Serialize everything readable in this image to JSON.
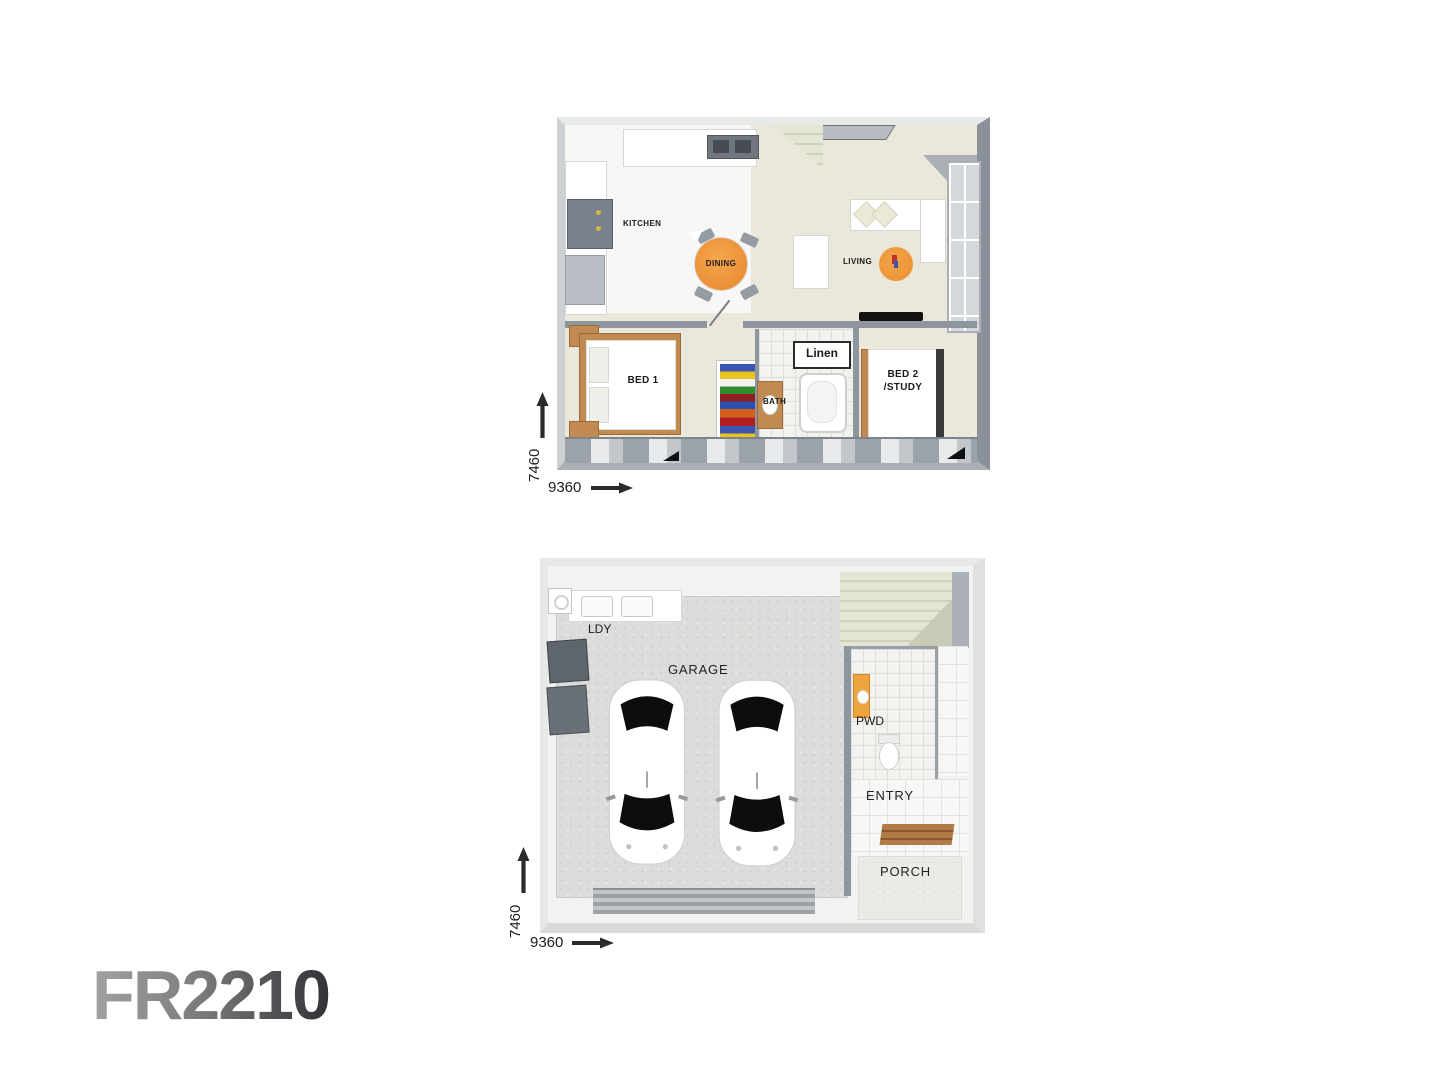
{
  "sheet": {
    "background": "#ffffff"
  },
  "logo": {
    "text": "FR2210",
    "gradient_start": "#a2a2a2",
    "gradient_end": "#323237"
  },
  "upper_floor": {
    "labels": {
      "kitchen": "KITCHEN",
      "dining": "DINING",
      "living": "LIVING",
      "bed1": "BED 1",
      "bath": "BATH",
      "linen": "Linen",
      "bed2_line1": "BED 2",
      "bed2_line2": "/STUDY"
    },
    "dimensions": {
      "depth": "7460",
      "width": "9360"
    }
  },
  "lower_floor": {
    "labels": {
      "laundry": "LDY",
      "garage": "GARAGE",
      "powder": "PWD",
      "entry": "ENTRY",
      "porch": "PORCH"
    },
    "dimensions": {
      "depth": "7460",
      "width": "9360"
    }
  },
  "icons": {
    "up_arrow": "↑",
    "right_arrow": "→",
    "car_top_view": "car",
    "toilet": "toilet",
    "sink": "sink",
    "dining_table": "round-table",
    "rug": "round-rug"
  },
  "colors": {
    "accent_orange": "#ef9434",
    "floor_sage": "#e9e8da",
    "wall_gray": "#8f959e",
    "concrete_gray": "#dcdcda",
    "wood_tan": "#c08a52",
    "stairs_beige": "#e2e3d0"
  }
}
